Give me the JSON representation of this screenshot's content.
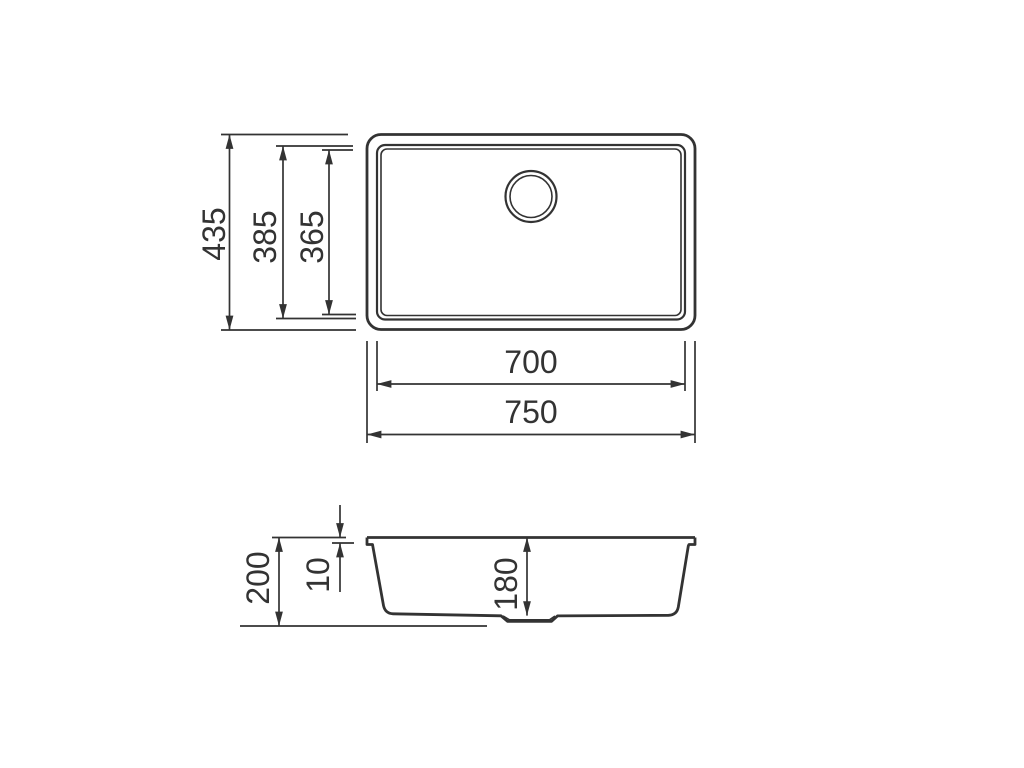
{
  "drawing": {
    "type": "technical-dimension-drawing",
    "subject": "undermount sink, plan view and section view",
    "colors": {
      "line": "#333333",
      "background": "#ffffff"
    }
  },
  "views": {
    "top": {
      "dims": {
        "overall_height": "435",
        "rim_height": "385",
        "bowl_height": "365",
        "bowl_width": "700",
        "overall_width": "750"
      }
    },
    "section": {
      "dims": {
        "overall_depth": "200",
        "rim_thickness": "10",
        "bowl_depth": "180"
      }
    }
  }
}
